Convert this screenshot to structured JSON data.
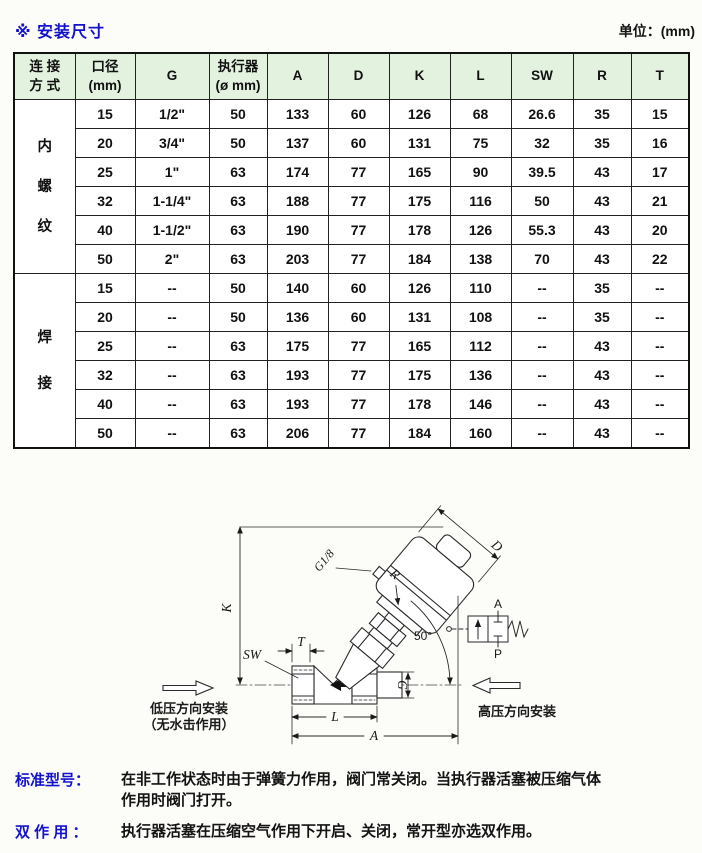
{
  "page": {
    "title": "※ 安装尺寸",
    "unit": "单位：(mm)"
  },
  "table": {
    "headers": [
      "连 接\n方 式",
      "口径\n(mm)",
      "G",
      "执行器\n(ø mm)",
      "A",
      "D",
      "K",
      "L",
      "SW",
      "R",
      "T"
    ],
    "sections": [
      {
        "label": "内\n螺\n纹",
        "rows": [
          [
            "15",
            "1/2\"",
            "50",
            "133",
            "60",
            "126",
            "68",
            "26.6",
            "35",
            "15"
          ],
          [
            "20",
            "3/4\"",
            "50",
            "137",
            "60",
            "131",
            "75",
            "32",
            "35",
            "16"
          ],
          [
            "25",
            "1\"",
            "63",
            "174",
            "77",
            "165",
            "90",
            "39.5",
            "43",
            "17"
          ],
          [
            "32",
            "1-1/4\"",
            "63",
            "188",
            "77",
            "175",
            "116",
            "50",
            "43",
            "21"
          ],
          [
            "40",
            "1-1/2\"",
            "63",
            "190",
            "77",
            "178",
            "126",
            "55.3",
            "43",
            "20"
          ],
          [
            "50",
            "2\"",
            "63",
            "203",
            "77",
            "184",
            "138",
            "70",
            "43",
            "22"
          ]
        ]
      },
      {
        "label": "焊\n接",
        "rows": [
          [
            "15",
            "--",
            "50",
            "140",
            "60",
            "126",
            "110",
            "--",
            "35",
            "--"
          ],
          [
            "20",
            "--",
            "50",
            "136",
            "60",
            "131",
            "108",
            "--",
            "35",
            "--"
          ],
          [
            "25",
            "--",
            "63",
            "175",
            "77",
            "165",
            "112",
            "--",
            "43",
            "--"
          ],
          [
            "32",
            "--",
            "63",
            "193",
            "77",
            "175",
            "136",
            "--",
            "43",
            "--"
          ],
          [
            "40",
            "--",
            "63",
            "193",
            "77",
            "178",
            "146",
            "--",
            "43",
            "--"
          ],
          [
            "50",
            "--",
            "63",
            "206",
            "77",
            "184",
            "160",
            "--",
            "43",
            "--"
          ]
        ]
      }
    ]
  },
  "drawing": {
    "dim_K": "K",
    "dim_D": "D",
    "dim_R": "R",
    "dim_T": "T",
    "dim_SW": "SW",
    "dim_G": "G",
    "dim_L": "L",
    "dim_A": "A",
    "port_label": "G1/8",
    "angle_label": "50°",
    "pneumatic": {
      "port_top": "A",
      "port_bottom": "P"
    },
    "low_pressure_label_line1": "低压方向安装",
    "low_pressure_label_line2": "（无水击作用）",
    "high_pressure_label": "高压方向安装"
  },
  "notes": [
    {
      "label": "标准型号：",
      "text": "在非工作状态时由于弹簧力作用，阀门常关闭。当执行器活塞被压缩气体\n作用时阀门打开。"
    },
    {
      "label": "双 作 用 ：",
      "text": "执行器活塞在压缩空气作用下开启、关闭，常开型亦选双作用。"
    }
  ],
  "colors": {
    "accent_blue": "#1212cd",
    "table_header_green": "#e3f2df"
  }
}
